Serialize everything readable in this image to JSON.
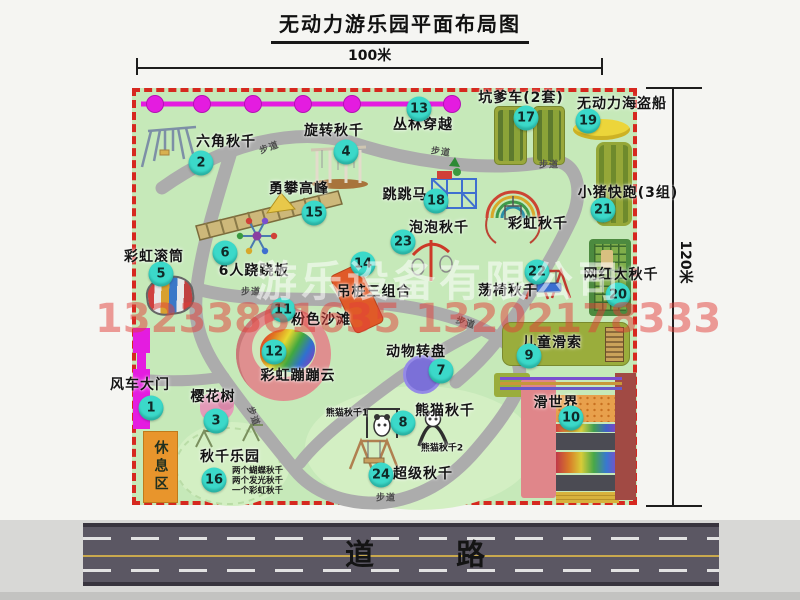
{
  "title": "无动力游乐园平面布局图",
  "dimensions": {
    "top": "100米",
    "right": "120米"
  },
  "road": {
    "label": "道 路"
  },
  "rest_area": {
    "label": "休息区"
  },
  "trail_label": "步道",
  "watermark": {
    "company": "游乐设备有限公司",
    "phones": "13233861635 13202178333"
  },
  "colors": {
    "badge": "#3bd9c9",
    "park_green": "#c6e9b9",
    "border_red": "#d6281f",
    "gate_magenta": "#e41ce0",
    "road_gray": "#5b5763",
    "rest_orange": "#e8952c",
    "zipline_magenta": "#e41ce0",
    "trail_gray": "#acacac"
  },
  "attractions": {
    "a1": {
      "num": "1",
      "name": "风车大门"
    },
    "a2": {
      "num": "2",
      "name": "六角秋千"
    },
    "a3": {
      "num": "3",
      "name": "樱花树"
    },
    "a4": {
      "num": "4",
      "name": "旋转秋千"
    },
    "a5": {
      "num": "5",
      "name": "彩虹滚筒"
    },
    "a6": {
      "num": "6",
      "name": "6人跷跷板"
    },
    "a7": {
      "num": "7",
      "name": "动物转盘"
    },
    "a8": {
      "num": "8",
      "name": "熊猫秋千"
    },
    "a9": {
      "num": "9",
      "name": "儿童滑索"
    },
    "a10": {
      "num": "10",
      "name": "滑世界"
    },
    "a11": {
      "num": "11",
      "name": "粉色沙滩"
    },
    "a12": {
      "num": "12",
      "name": "彩虹蹦蹦云"
    },
    "a13": {
      "num": "13",
      "name": "丛林穿越"
    },
    "a14": {
      "num": "14",
      "name": "吊桩三组合"
    },
    "a15": {
      "num": "15",
      "name": "勇攀高峰"
    },
    "a16": {
      "num": "16",
      "name": "秋千乐园",
      "notes": [
        "两个蝴蝶秋千",
        "两个发光秋千",
        "一个彩虹秋千"
      ]
    },
    "a17": {
      "num": "17",
      "name": "坑爹车(2套)"
    },
    "a18": {
      "num": "18",
      "name": "跳跳马"
    },
    "a19": {
      "num": "19",
      "name": "无动力海盗船"
    },
    "a20": {
      "num": "20",
      "name": "网红大秋千"
    },
    "a21": {
      "num": "21",
      "name": "小猪快跑(3组)"
    },
    "a22": {
      "num": "22",
      "name": "荡椅秋千"
    },
    "a23": {
      "num": "23",
      "name": "泡泡秋千"
    },
    "a24": {
      "num": "24",
      "name": "超级秋千"
    },
    "rainbow_swing": {
      "name": "彩虹秋千"
    },
    "panda1": {
      "name": "熊猫秋千1"
    },
    "panda2": {
      "name": "熊猫秋千2"
    }
  }
}
